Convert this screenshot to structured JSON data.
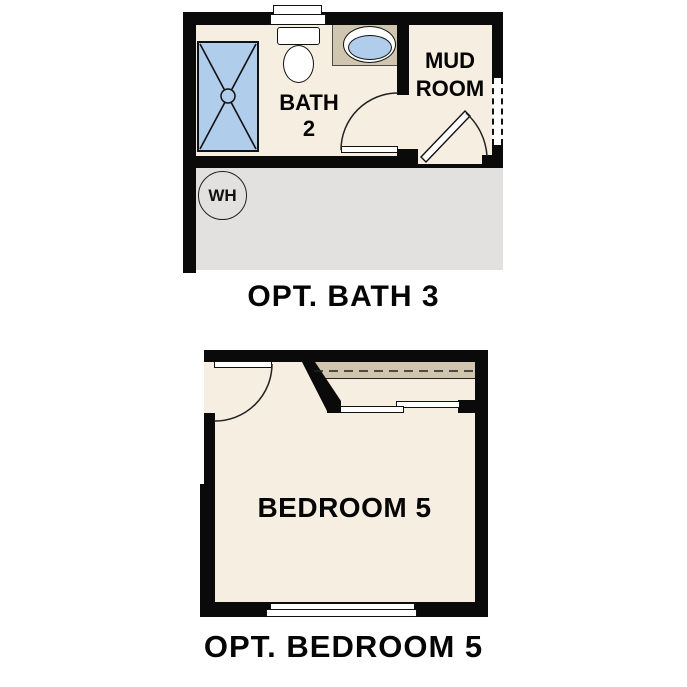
{
  "colors": {
    "wall": "#0a0a0a",
    "floor_cream": "#f5eee1",
    "counter_tan": "#d0c5ae",
    "fixture_blue": "#b0cdeb",
    "garage_gray": "#e2e1df",
    "background": "#ffffff",
    "text": "#050505"
  },
  "bath_plan": {
    "caption": "OPT. BATH 3",
    "room_labels": {
      "bath_line1": "BATH",
      "bath_line2": "2",
      "mudroom_line1": "MUD",
      "mudroom_line2": "ROOM"
    },
    "water_heater_label": "WH"
  },
  "bedroom_plan": {
    "caption": "OPT. BEDROOM 5",
    "room_label": "BEDROOM 5"
  }
}
